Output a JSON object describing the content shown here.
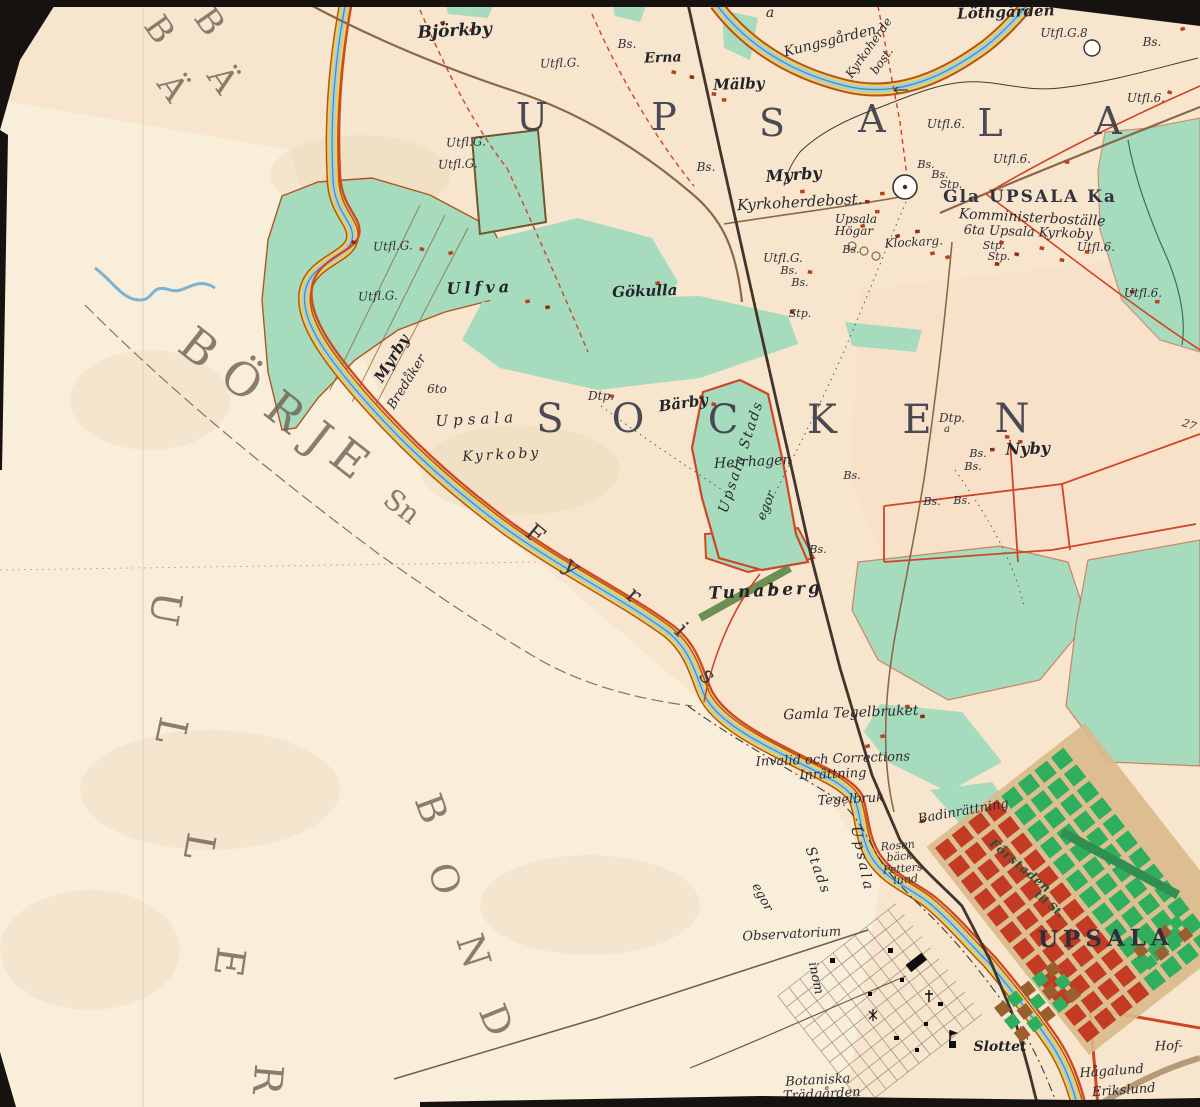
{
  "map": {
    "colors": {
      "paper": "#f7e6cd",
      "paperLight": "#faf2e1",
      "pinkTint": "#f7ddc4",
      "green": "#a6dbbd",
      "greenDark": "#4e9a67",
      "cityGreen": "#2fae5e",
      "brick": "#c23b22",
      "redLine": "#cf4526",
      "roadRed": "#d2491f",
      "roadBrown": "#8a6847",
      "river": "#9fd0e8",
      "riverLine": "#4e86ad",
      "bank": "#f0d04f",
      "bankLine": "#b3541e",
      "rail": "#42362c",
      "ink": "#2b2b33",
      "border": "#151210"
    },
    "labels": [
      {
        "t": "U",
        "x": 532,
        "y": 130,
        "r": 0,
        "s": 38,
        "c": "big"
      },
      {
        "t": "P",
        "x": 664,
        "y": 130,
        "r": 0,
        "s": 38,
        "c": "big"
      },
      {
        "t": "S",
        "x": 772,
        "y": 136,
        "r": 0,
        "s": 38,
        "c": "big"
      },
      {
        "t": "A",
        "x": 872,
        "y": 132,
        "r": 0,
        "s": 38,
        "c": "big"
      },
      {
        "t": "L",
        "x": 990,
        "y": 136,
        "r": 0,
        "s": 38,
        "c": "big"
      },
      {
        "t": "A",
        "x": 1108,
        "y": 134,
        "r": 0,
        "s": 38,
        "c": "big"
      },
      {
        "t": "S",
        "x": 550,
        "y": 432,
        "r": 0,
        "s": 40,
        "c": "big"
      },
      {
        "t": "O",
        "x": 628,
        "y": 432,
        "r": 0,
        "s": 40,
        "c": "big"
      },
      {
        "t": "C",
        "x": 723,
        "y": 433,
        "r": 0,
        "s": 40,
        "c": "big"
      },
      {
        "t": "K",
        "x": 822,
        "y": 433,
        "r": 0,
        "s": 40,
        "c": "big"
      },
      {
        "t": "E",
        "x": 917,
        "y": 433,
        "r": 0,
        "s": 40,
        "c": "big"
      },
      {
        "t": "N",
        "x": 1012,
        "y": 432,
        "r": 0,
        "s": 40,
        "c": "big"
      },
      {
        "t": "UPSALA",
        "x": 1106,
        "y": 946,
        "r": -1,
        "s": 23,
        "c": "city",
        "ls": 5
      },
      {
        "t": "Gla UPSALA Ka",
        "x": 1030,
        "y": 202,
        "r": 0,
        "s": 17,
        "c": "caps",
        "ls": 2
      },
      {
        "t": "B",
        "x": 189,
        "y": 360,
        "r": 38,
        "s": 46,
        "c": "faded"
      },
      {
        "t": "Ö",
        "x": 232,
        "y": 392,
        "r": 38,
        "s": 46,
        "c": "faded"
      },
      {
        "t": "R",
        "x": 275,
        "y": 424,
        "r": 38,
        "s": 46,
        "c": "faded"
      },
      {
        "t": "J",
        "x": 309,
        "y": 450,
        "r": 38,
        "s": 46,
        "c": "faded"
      },
      {
        "t": "E",
        "x": 340,
        "y": 471,
        "r": 38,
        "s": 46,
        "c": "faded"
      },
      {
        "t": "Sn",
        "x": 396,
        "y": 514,
        "r": 38,
        "s": 28,
        "c": "faded"
      },
      {
        "t": "U",
        "x": 152,
        "y": 606,
        "r": 100,
        "s": 40,
        "c": "faded"
      },
      {
        "t": "L",
        "x": 158,
        "y": 728,
        "r": 102,
        "s": 40,
        "c": "faded"
      },
      {
        "t": "L",
        "x": 186,
        "y": 844,
        "r": 100,
        "s": 40,
        "c": "faded"
      },
      {
        "t": "E",
        "x": 216,
        "y": 960,
        "r": 98,
        "s": 40,
        "c": "faded"
      },
      {
        "t": "R",
        "x": 254,
        "y": 1078,
        "r": 95,
        "s": 40,
        "c": "faded"
      },
      {
        "t": "B",
        "x": 419,
        "y": 813,
        "r": 70,
        "s": 38,
        "c": "faded"
      },
      {
        "t": "O",
        "x": 432,
        "y": 882,
        "r": 75,
        "s": 38,
        "c": "faded"
      },
      {
        "t": "N",
        "x": 461,
        "y": 955,
        "r": 72,
        "s": 38,
        "c": "faded"
      },
      {
        "t": "D",
        "x": 484,
        "y": 1025,
        "r": 68,
        "s": 38,
        "c": "faded"
      },
      {
        "t": "B",
        "x": 150,
        "y": 36,
        "r": 55,
        "s": 34,
        "c": "faded"
      },
      {
        "t": "Ä",
        "x": 163,
        "y": 94,
        "r": 55,
        "s": 34,
        "c": "faded"
      },
      {
        "t": "B",
        "x": 200,
        "y": 28,
        "r": 55,
        "s": 34,
        "c": "faded"
      },
      {
        "t": "Ä",
        "x": 213,
        "y": 86,
        "r": 55,
        "s": 34,
        "c": "faded"
      },
      {
        "t": "F",
        "x": 530,
        "y": 540,
        "r": 40,
        "s": 24,
        "c": "riv"
      },
      {
        "t": "y",
        "x": 567,
        "y": 572,
        "r": 42,
        "s": 24,
        "c": "riv"
      },
      {
        "t": "r",
        "x": 629,
        "y": 601,
        "r": 40,
        "s": 24,
        "c": "riv"
      },
      {
        "t": "i",
        "x": 676,
        "y": 635,
        "r": 45,
        "s": 24,
        "c": "riv"
      },
      {
        "t": "s",
        "x": 702,
        "y": 681,
        "r": 48,
        "s": 24,
        "c": "riv"
      },
      {
        "t": "Björkby",
        "x": 455,
        "y": 36,
        "r": -3,
        "s": 17,
        "c": "pb"
      },
      {
        "t": "Erna",
        "x": 663,
        "y": 62,
        "r": -2,
        "s": 14,
        "c": "pb"
      },
      {
        "t": "Mälby",
        "x": 739,
        "y": 89,
        "r": -2,
        "s": 15,
        "c": "pb"
      },
      {
        "t": "Löthgården",
        "x": 1006,
        "y": 17,
        "r": -2,
        "s": 15,
        "c": "pb"
      },
      {
        "t": "Kungsgården",
        "x": 831,
        "y": 45,
        "r": -14,
        "s": 14,
        "c": "p"
      },
      {
        "t": "Kyrkoherde",
        "x": 872,
        "y": 50,
        "r": -55,
        "s": 12,
        "c": "p"
      },
      {
        "t": "bost.",
        "x": 885,
        "y": 63,
        "r": -55,
        "s": 12,
        "c": "p"
      },
      {
        "t": "a",
        "x": 770,
        "y": 17,
        "r": 0,
        "s": 14,
        "c": "sm"
      },
      {
        "t": "Myrby",
        "x": 794,
        "y": 180,
        "r": -4,
        "s": 16,
        "c": "pb"
      },
      {
        "t": "Kyrkoherdebost.",
        "x": 800,
        "y": 207,
        "r": -3,
        "s": 15,
        "c": "p"
      },
      {
        "t": "Upsala",
        "x": 856,
        "y": 223,
        "r": 0,
        "s": 12,
        "c": "p"
      },
      {
        "t": "Högar",
        "x": 854,
        "y": 235,
        "r": 0,
        "s": 12,
        "c": "p"
      },
      {
        "t": "Klockarg.",
        "x": 914,
        "y": 246,
        "r": -3,
        "s": 12,
        "c": "p"
      },
      {
        "t": "Komministerboställe",
        "x": 1032,
        "y": 222,
        "r": 3,
        "s": 14,
        "c": "p"
      },
      {
        "t": "6ta Upsala Kyrkoby",
        "x": 1028,
        "y": 236,
        "r": 2,
        "s": 13,
        "c": "p"
      },
      {
        "t": "Ulfva",
        "x": 480,
        "y": 293,
        "r": -2,
        "s": 16,
        "c": "pb",
        "ls": 4
      },
      {
        "t": "Gökulla",
        "x": 645,
        "y": 296,
        "r": -2,
        "s": 15,
        "c": "pb"
      },
      {
        "t": "Myrby",
        "x": 396,
        "y": 361,
        "r": -58,
        "s": 15,
        "c": "pb"
      },
      {
        "t": "Bredåker",
        "x": 410,
        "y": 384,
        "r": -58,
        "s": 13,
        "c": "p"
      },
      {
        "t": "6to",
        "x": 437,
        "y": 393,
        "r": 0,
        "s": 12,
        "c": "sm"
      },
      {
        "t": "Upsala",
        "x": 477,
        "y": 424,
        "r": -3,
        "s": 15,
        "c": "p",
        "ls": 5
      },
      {
        "t": "Kyrkoby",
        "x": 502,
        "y": 459,
        "r": -3,
        "s": 14,
        "c": "p",
        "ls": 3
      },
      {
        "t": "Dtp.",
        "x": 601,
        "y": 400,
        "r": 0,
        "s": 12,
        "c": "sm"
      },
      {
        "t": "Bärby",
        "x": 684,
        "y": 408,
        "r": -8,
        "s": 15,
        "c": "pb"
      },
      {
        "t": "Herrhagen",
        "x": 753,
        "y": 466,
        "r": -3,
        "s": 14,
        "c": "p"
      },
      {
        "t": "Upsala Stads",
        "x": 745,
        "y": 458,
        "r": -72,
        "s": 14,
        "c": "p",
        "ls": 2
      },
      {
        "t": "egor",
        "x": 770,
        "y": 507,
        "r": -68,
        "s": 13,
        "c": "p"
      },
      {
        "t": "Dtp.",
        "x": 952,
        "y": 422,
        "r": 0,
        "s": 12,
        "c": "sm"
      },
      {
        "t": "a",
        "x": 947,
        "y": 432,
        "r": 0,
        "s": 10,
        "c": "sm"
      },
      {
        "t": "Nyby",
        "x": 1028,
        "y": 454,
        "r": -2,
        "s": 16,
        "c": "pb"
      },
      {
        "t": "Tunaberg",
        "x": 766,
        "y": 596,
        "r": -3,
        "s": 17,
        "c": "pb",
        "ls": 3
      },
      {
        "t": "Gamla Tegelbruket",
        "x": 851,
        "y": 717,
        "r": -2,
        "s": 14,
        "c": "p"
      },
      {
        "t": "Invalid och Corrections",
        "x": 833,
        "y": 763,
        "r": -2,
        "s": 13,
        "c": "p"
      },
      {
        "t": "Inrättning",
        "x": 833,
        "y": 778,
        "r": -2,
        "s": 13,
        "c": "p"
      },
      {
        "t": "Tegelbruk",
        "x": 851,
        "y": 803,
        "r": -3,
        "s": 13,
        "c": "p"
      },
      {
        "t": "Badinrättning",
        "x": 964,
        "y": 815,
        "r": -10,
        "s": 13,
        "c": "p"
      },
      {
        "t": "Rosen",
        "x": 898,
        "y": 849,
        "r": -5,
        "s": 11,
        "c": "sm"
      },
      {
        "t": "bäck",
        "x": 900,
        "y": 860,
        "r": -5,
        "s": 11,
        "c": "sm"
      },
      {
        "t": "Petters",
        "x": 903,
        "y": 872,
        "r": -5,
        "s": 11,
        "c": "sm"
      },
      {
        "t": "lund",
        "x": 906,
        "y": 883,
        "r": -5,
        "s": 11,
        "c": "sm"
      },
      {
        "t": "Upsala",
        "x": 858,
        "y": 860,
        "r": 78,
        "s": 14,
        "c": "p",
        "ls": 3
      },
      {
        "t": "Stads",
        "x": 814,
        "y": 872,
        "r": 70,
        "s": 14,
        "c": "p",
        "ls": 2
      },
      {
        "t": "egor",
        "x": 759,
        "y": 899,
        "r": 62,
        "s": 13,
        "c": "p"
      },
      {
        "t": "inom",
        "x": 812,
        "y": 979,
        "r": 78,
        "s": 13,
        "c": "p"
      },
      {
        "t": "Observatorium",
        "x": 792,
        "y": 938,
        "r": -3,
        "s": 13,
        "c": "p"
      },
      {
        "t": "Förstaden",
        "x": 1018,
        "y": 869,
        "r": 40,
        "s": 12,
        "c": "grn",
        "ls": 1
      },
      {
        "t": "til St.",
        "x": 1047,
        "y": 907,
        "r": 40,
        "s": 11,
        "c": "grn"
      },
      {
        "t": "Slottet",
        "x": 1000,
        "y": 1051,
        "r": 0,
        "s": 14,
        "c": "pb"
      },
      {
        "t": "Botaniska",
        "x": 818,
        "y": 1084,
        "r": -3,
        "s": 13,
        "c": "p"
      },
      {
        "t": "Trädgården",
        "x": 822,
        "y": 1098,
        "r": -3,
        "s": 13,
        "c": "p"
      },
      {
        "t": "Hågalund",
        "x": 1112,
        "y": 1075,
        "r": -4,
        "s": 13,
        "c": "p"
      },
      {
        "t": "Erikslund",
        "x": 1124,
        "y": 1094,
        "r": -4,
        "s": 13,
        "c": "p"
      },
      {
        "t": "Hof-",
        "x": 1169,
        "y": 1050,
        "r": -2,
        "s": 13,
        "c": "p"
      },
      {
        "t": "Bs.",
        "x": 627,
        "y": 48,
        "r": 0,
        "s": 12,
        "c": "sm"
      },
      {
        "t": "Utfl.G.",
        "x": 560,
        "y": 67,
        "r": -2,
        "s": 12,
        "c": "sm"
      },
      {
        "t": "Utfl.G.8",
        "x": 1064,
        "y": 37,
        "r": 0,
        "s": 12,
        "c": "sm"
      },
      {
        "t": "Utfl.",
        "x": 1162,
        "y": 15,
        "r": 0,
        "s": 12,
        "c": "sm"
      },
      {
        "t": "Bs.",
        "x": 1152,
        "y": 46,
        "r": 0,
        "s": 12,
        "c": "sm"
      },
      {
        "t": "Utfl.6.",
        "x": 1146,
        "y": 102,
        "r": 0,
        "s": 12,
        "c": "sm"
      },
      {
        "t": "Utfl.6.",
        "x": 946,
        "y": 128,
        "r": 0,
        "s": 12,
        "c": "sm"
      },
      {
        "t": "Utfl.6.",
        "x": 1012,
        "y": 163,
        "r": 0,
        "s": 12,
        "c": "sm"
      },
      {
        "t": "Utfl.6.",
        "x": 1096,
        "y": 251,
        "r": 0,
        "s": 12,
        "c": "sm"
      },
      {
        "t": "Utfl.6.",
        "x": 1143,
        "y": 297,
        "r": 0,
        "s": 12,
        "c": "sm"
      },
      {
        "t": "Bs.",
        "x": 706,
        "y": 171,
        "r": 0,
        "s": 12,
        "c": "sm"
      },
      {
        "t": "Bs.",
        "x": 926,
        "y": 168,
        "r": 0,
        "s": 11,
        "c": "sm"
      },
      {
        "t": "Bs.",
        "x": 940,
        "y": 178,
        "r": 0,
        "s": 11,
        "c": "sm"
      },
      {
        "t": "Stp.",
        "x": 951,
        "y": 188,
        "r": 0,
        "s": 11,
        "c": "sm"
      },
      {
        "t": "Bs.",
        "x": 851,
        "y": 253,
        "r": 0,
        "s": 11,
        "c": "sm"
      },
      {
        "t": "Stp.",
        "x": 994,
        "y": 249,
        "r": 0,
        "s": 11,
        "c": "sm"
      },
      {
        "t": "Stp.",
        "x": 999,
        "y": 260,
        "r": 0,
        "s": 11,
        "c": "sm"
      },
      {
        "t": "Utfl.G.",
        "x": 466,
        "y": 146,
        "r": -2,
        "s": 12,
        "c": "sm"
      },
      {
        "t": "Utfl.G.",
        "x": 458,
        "y": 168,
        "r": -2,
        "s": 12,
        "c": "sm"
      },
      {
        "t": "Utfl.G.",
        "x": 393,
        "y": 250,
        "r": -2,
        "s": 12,
        "c": "sm"
      },
      {
        "t": "Utfl.G.",
        "x": 378,
        "y": 300,
        "r": -2,
        "s": 12,
        "c": "sm"
      },
      {
        "t": "Utfl.G.",
        "x": 783,
        "y": 262,
        "r": 0,
        "s": 12,
        "c": "sm"
      },
      {
        "t": "Bs.",
        "x": 789,
        "y": 274,
        "r": 0,
        "s": 11,
        "c": "sm"
      },
      {
        "t": "Bs.",
        "x": 800,
        "y": 286,
        "r": 0,
        "s": 11,
        "c": "sm"
      },
      {
        "t": "Stp.",
        "x": 800,
        "y": 317,
        "r": 0,
        "s": 11,
        "c": "sm"
      },
      {
        "t": "Bs.",
        "x": 852,
        "y": 479,
        "r": 0,
        "s": 11,
        "c": "sm"
      },
      {
        "t": "Bs.",
        "x": 978,
        "y": 457,
        "r": 0,
        "s": 11,
        "c": "sm"
      },
      {
        "t": "Bs.",
        "x": 973,
        "y": 470,
        "r": 0,
        "s": 11,
        "c": "sm"
      },
      {
        "t": "Bs.",
        "x": 932,
        "y": 505,
        "r": 0,
        "s": 11,
        "c": "sm"
      },
      {
        "t": "Bs.",
        "x": 962,
        "y": 504,
        "r": 0,
        "s": 11,
        "c": "sm"
      },
      {
        "t": "27",
        "x": 1188,
        "y": 428,
        "r": 20,
        "s": 11,
        "c": "sm"
      },
      {
        "t": "Bs.",
        "x": 818,
        "y": 553,
        "r": 0,
        "s": 11,
        "c": "sm"
      }
    ]
  }
}
